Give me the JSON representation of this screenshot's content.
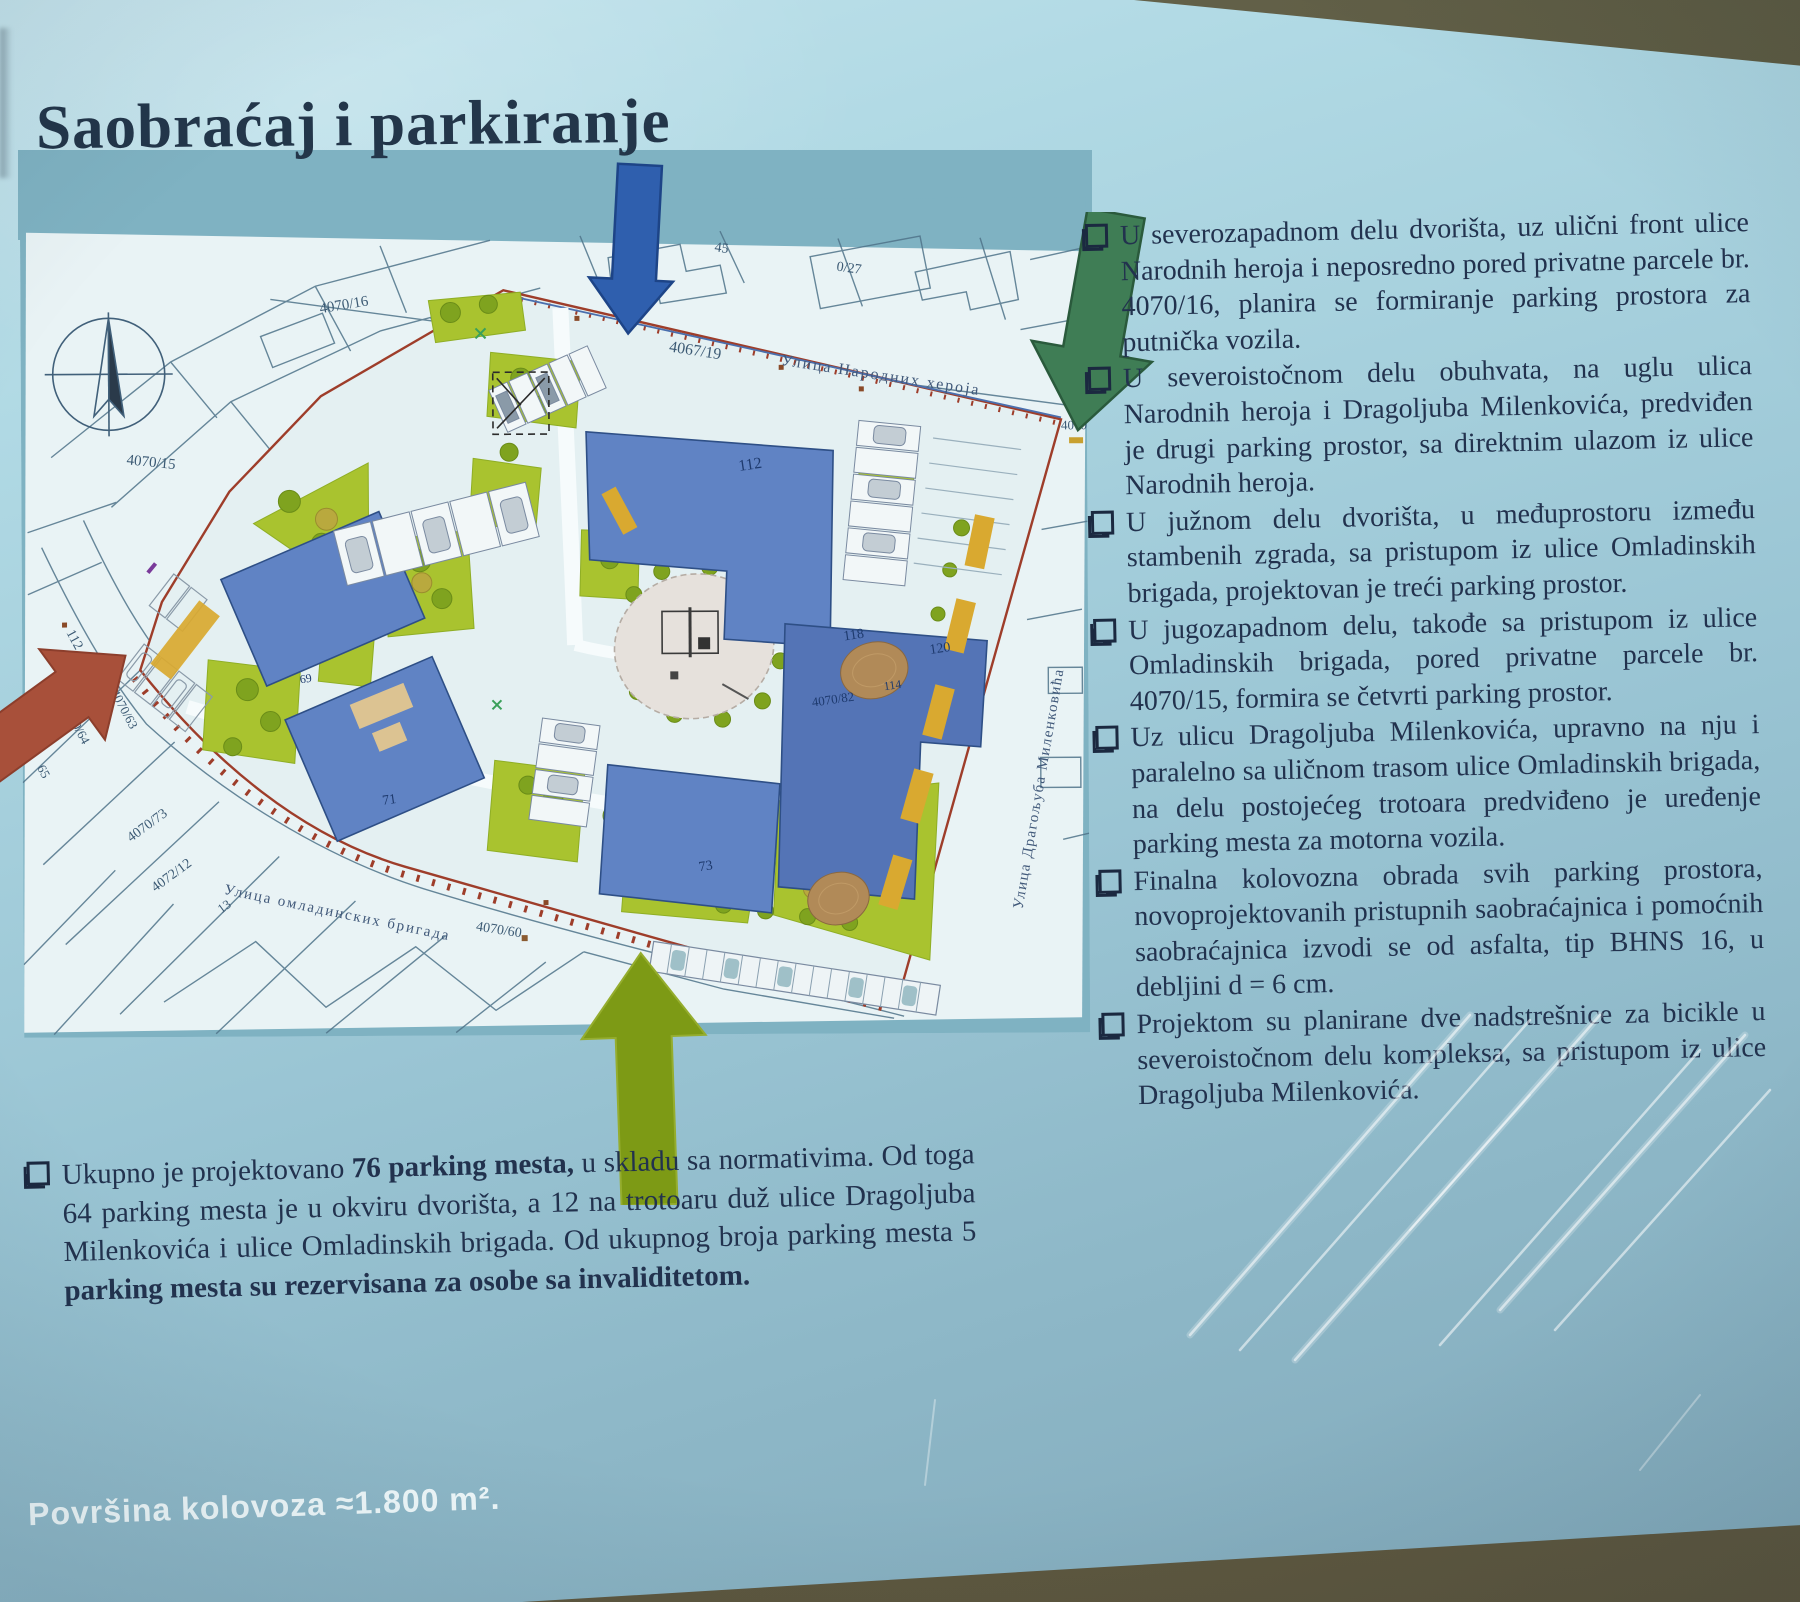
{
  "title": "Saobraćaj i parkiranje",
  "map": {
    "streets": {
      "narodnih_heroja": "Улица Народних хероја",
      "dragoljuba_milenkovica": "Улица Драгољуба Миленковића",
      "omladinskih_brigada": "Улица омладинских бригада"
    },
    "parcels": {
      "p4067_19": "4067/19",
      "p4070_16": "4070/16",
      "p4070_15": "4070/15",
      "p43": "43",
      "p45": "45",
      "p0_27": "0/27",
      "p4070": "4070",
      "p4070_82": "4070/82",
      "p4070_60": "4070/60",
      "p112_left": "112",
      "p4070_63": "4070/63",
      "p4070_64": "4070/64",
      "p65": "65",
      "p4070_73": "4070/73",
      "p4072_12": "4072/12",
      "p13": "13"
    },
    "buildings": {
      "b112": "112",
      "b118": "118",
      "b120": "120",
      "b114": "114",
      "b69": "69",
      "b71": "71",
      "b73": "73"
    },
    "colors": {
      "arrow_north_blue": "#2f5fae",
      "arrow_northeast_green": "#3f7d55",
      "arrow_west_red": "#a8503a",
      "arrow_south_olive": "#7d9a15",
      "building_blue": "#6083c4",
      "lawn_green": "#a9c32f",
      "boundary_red": "#9e3d2a"
    }
  },
  "bullets": [
    "U severozapadnom delu dvorišta, uz ulični front ulice Narodnih heroja i neposredno pored privatne parcele br. 4070/16, planira se formiranje parking prostora za putnička vozila.",
    "U severoistočnom delu obuhvata, na uglu ulica Narodnih heroja i Dragoljuba Milenkovića, predviđen je drugi parking prostor, sa direktnim ulazom iz ulice Narodnih heroja.",
    "U južnom delu dvorišta, u međuprostoru između stambenih zgrada, sa pristupom iz ulice Omladinskih brigada, projektovan je treći parking prostor.",
    "U jugozapadnom delu, takođe sa pristupom iz ulice Omladinskih brigada, pored privatne parcele br. 4070/15, formira se četvrti parking prostor.",
    "Uz ulicu Dragoljuba Milenkovića, upravno na nju i paralelno sa uličnom trasom ulice Omladinskih brigada, na delu postojećeg trotoara predviđeno je uređenje parking mesta za motorna vozila.",
    "Finalna kolovozna obrada svih parking prostora, novoprojektovanih pristupnih saobraćajnica i pomoćnih saobraćajnica izvodi se od asfalta, tip BHNS 16, u debljini d = 6 cm.",
    "Projektom su planirane dve nadstrešnice za bicikle u severoistočnom delu kompleksa, sa pristupom iz ulice Dragoljuba Milenkovića."
  ],
  "summary": {
    "seg1": "Ukupno je projektovano ",
    "seg2": "76 parking mesta,",
    "seg3": " u skladu sa normativima. Od toga 64 parking mesta je u okviru dvorišta, a 12 na trotoaru duž ulice Dragoljuba Milenkovića i ulice Omladinskih brigada. Od ukupnog broja parking mesta 5 ",
    "seg4": "parking mesta su rezervisana za osobe sa invaliditetom."
  },
  "footer": {
    "area_label": "Površina kolovoza ≈1.800 m²."
  }
}
